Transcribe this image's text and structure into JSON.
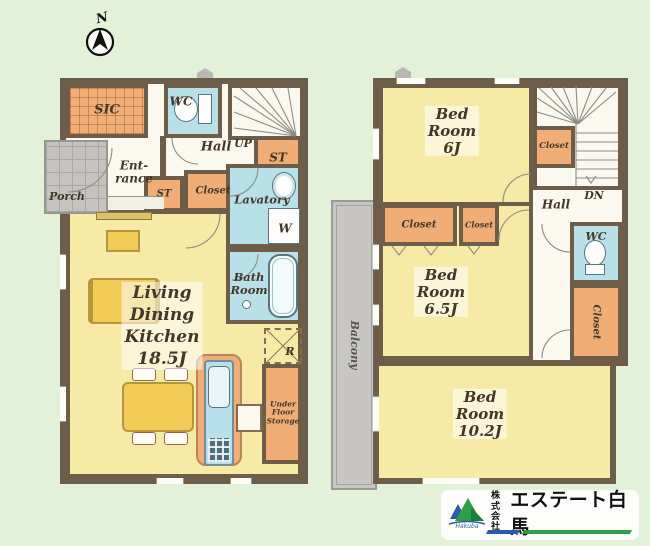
{
  "compass": "N",
  "colors": {
    "background": "#e3f1d9",
    "wall": "#6e5e49",
    "room_yellow": "#f6eaa6",
    "closet_orange": "#f0ae76",
    "wet_blue": "#b7e0e9",
    "hall_cream": "#fbf8ef",
    "furniture_yellow": "#f1cb55",
    "porch_gray": "#c4c3bf",
    "balcony_gray": "#c7c6c2",
    "logo_green": "#2f9e49",
    "logo_blue": "#2a5caa"
  },
  "icons": {
    "compass": "north-arrow",
    "toilet": "toilet-plan-symbol",
    "bathtub": "bathtub-plan-symbol",
    "washer": "washing-machine-cross-box",
    "fridge": "refrigerator-dashed-cross-box",
    "logo_mark": "mountain-logo"
  },
  "floor1": {
    "sic": "SIC",
    "wc": "WC",
    "entrance": [
      "Ent-",
      "rance"
    ],
    "porch": "Porch",
    "hall": "Hall",
    "up": "UP",
    "st_a": "ST",
    "st_b": "ST",
    "closet": "Closet",
    "lavatory": "Lavatory",
    "washer": "W",
    "bath": [
      "Bath",
      "Room"
    ],
    "fridge": "R",
    "ldk": [
      "Living",
      "Dining",
      "Kitchen",
      "18.5J"
    ],
    "ufs": [
      "Under",
      "Floor",
      "Storage"
    ]
  },
  "floor2": {
    "bed6": [
      "Bed",
      "Room",
      "6J"
    ],
    "closet_a": "Closet",
    "dn": "DN",
    "hall": "Hall",
    "closet_b": "Closet",
    "closet_c": "Closet",
    "bed65": [
      "Bed",
      "Room",
      "6.5J"
    ],
    "wc": "WC",
    "closet_d": "Closet",
    "bed102": [
      "Bed",
      "Room",
      "10.2J"
    ],
    "balcony": "Balcony"
  },
  "logo": {
    "prefix": [
      "株式",
      "会社"
    ],
    "name": "エステート白馬",
    "script": "Hakuba"
  }
}
